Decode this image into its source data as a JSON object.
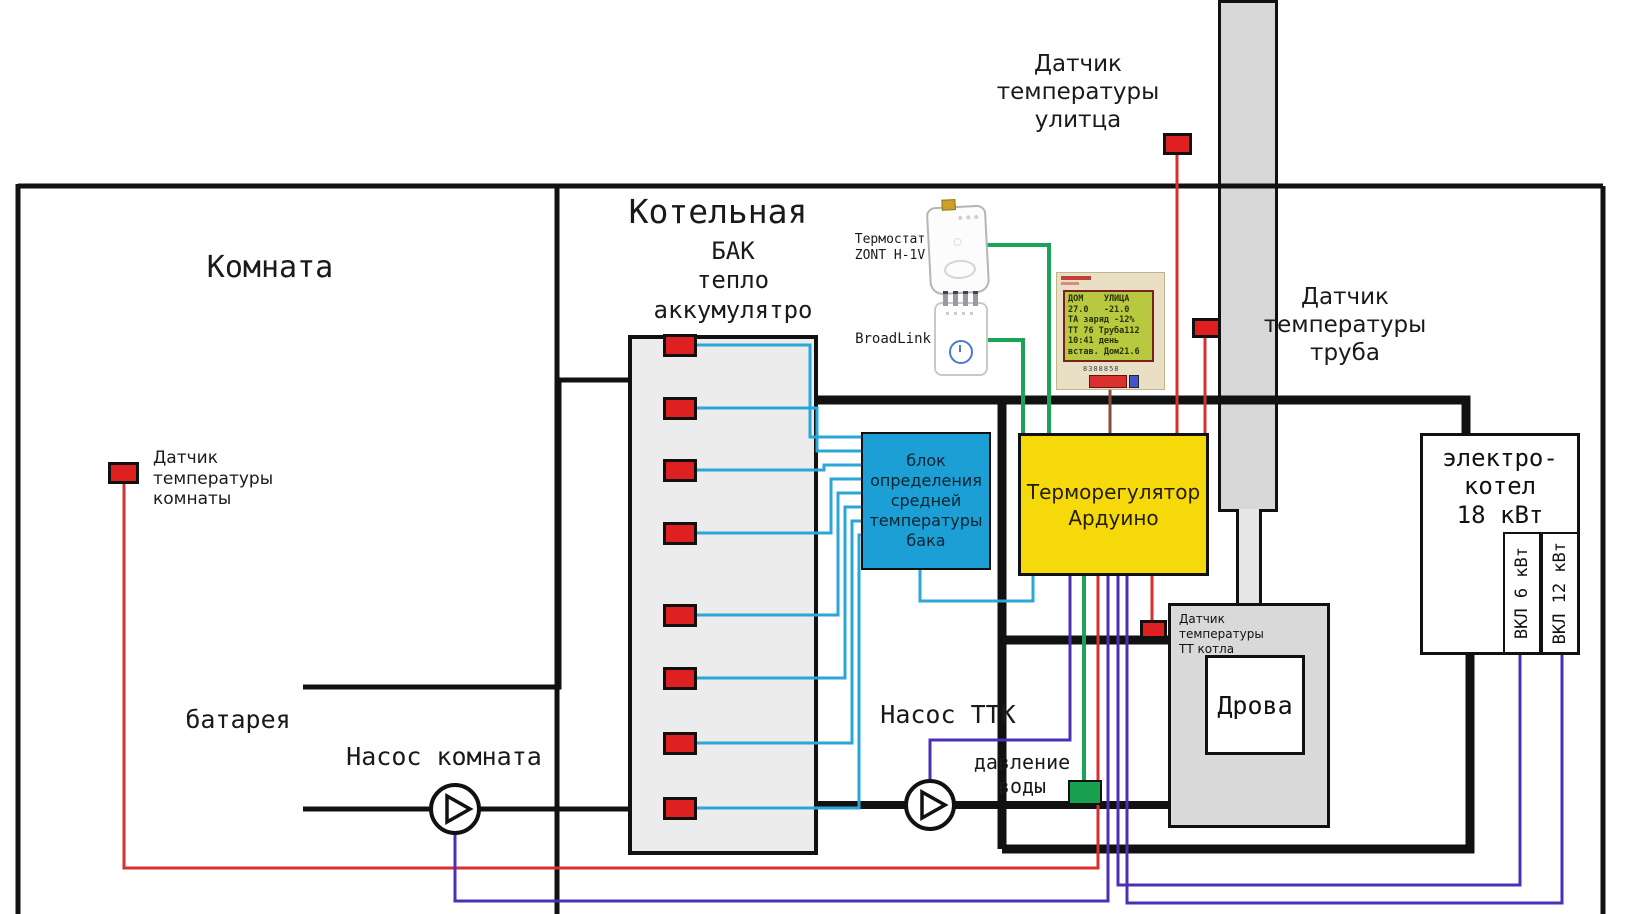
{
  "titles": {
    "room": "Комната",
    "boiler_room": "Котельная"
  },
  "tank": {
    "title": "БАК\nтепло\nаккумулятро",
    "sensor_count": 8
  },
  "sensors": {
    "street": "Датчик\nтемпературы\nулитца",
    "pipe": "Датчик\nтемпературы\nтруба",
    "room": "Датчик\nтемпературы\nкомнаты",
    "tt_boiler": "Датчик\nтемпературы\nТТ котла"
  },
  "components": {
    "radiator": "батарея",
    "room_pump": "Насос комната",
    "ttk_pump": "Насос ТТК",
    "water_pressure": "давление\nводы",
    "firewood": "Дрова"
  },
  "devices": {
    "thermostat": "Термостат\nZONT H-1V",
    "broadlink": "BroadLink"
  },
  "blocks": {
    "avg_temp": "блок\nопределения\nсредней\nтемпературы\nбака",
    "arduino": "Терморегулятор\nАрдуино"
  },
  "electric_boiler": {
    "title": "электро-\nкотел\n18 кВт",
    "stage1": "ВКЛ 6 кВт",
    "stage2": "ВКЛ 12 кВт"
  },
  "lcd": {
    "lines": [
      "ДОМ    УЛИЦА",
      "27.0   -21.0",
      "ТА заряд -12%",
      "ТТ 76 Труба112",
      "10:41 день",
      "встав. Дом21.6"
    ],
    "char_row": "8388858"
  },
  "colors": {
    "sensor_red": "#df2020",
    "pressure_green": "#17a14e",
    "wire_cyan": "#2aa7d6",
    "wire_green": "#1ca35a",
    "wire_purple": "#4b2fb5",
    "wire_red": "#d92f2f",
    "wire_brown": "#8a4a3a",
    "pipe_black": "#111111",
    "box_blue": "#1b9fd4",
    "box_yellow": "#f6d90a",
    "chimney_gray": "#d8d8d8",
    "boiler_gray": "#d9d9d9",
    "lcd_screen": "#b9c93f",
    "lcd_board": "#e9dfc5"
  }
}
